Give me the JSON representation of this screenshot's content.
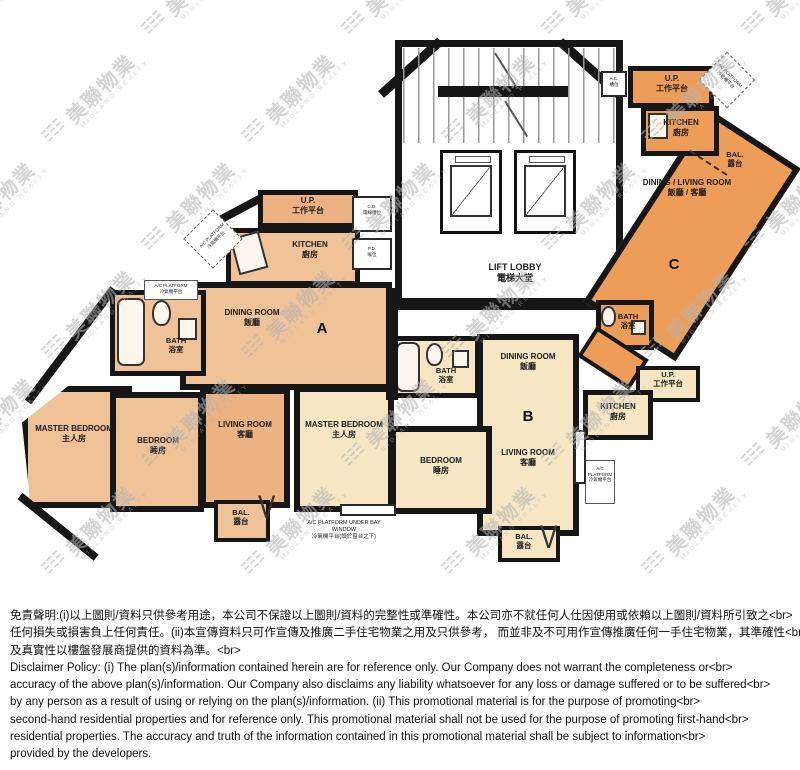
{
  "watermark": {
    "text": "美聯物業",
    "subtext": "MIDLAND REALTY"
  },
  "symbols": {
    "door_swing": "V"
  },
  "colors": {
    "wall": "#161616",
    "unit_a": "#f0c298",
    "unit_a_living": "#ecb281",
    "unit_b": "#f7e6c4",
    "unit_c": "#ee9d58",
    "core": "#ffffff"
  },
  "units": {
    "a": {
      "letter": "A"
    },
    "b": {
      "letter": "B"
    },
    "c": {
      "letter": "C"
    }
  },
  "labels": {
    "lift_lobby": {
      "en": "LIFT LOBBY",
      "zh": "電梯大堂"
    },
    "a_up": {
      "en": "U.P.",
      "zh": "工作平台"
    },
    "a_kitchen": {
      "en": "KITCHEN",
      "zh": "廚房"
    },
    "a_cd": {
      "en": "C.D.",
      "zh": "電線槽位"
    },
    "a_pd": {
      "en": "P.D.",
      "zh": "喉位"
    },
    "a_acp": {
      "en": "A/C PLATFORM",
      "zh": "冷氣機平台"
    },
    "a_bath_acp": {
      "en": "A/C PLATFORM",
      "zh": "冷氣機平台"
    },
    "a_bath": {
      "en": "BATH",
      "zh": "浴室"
    },
    "a_dining": {
      "en": "DINING ROOM",
      "zh": "飯廳"
    },
    "a_living": {
      "en": "LIVING ROOM",
      "zh": "客廳"
    },
    "a_master": {
      "en": "MASTER BEDROOM",
      "zh": "主人房"
    },
    "a_bedroom": {
      "en": "BEDROOM",
      "zh": "睡房"
    },
    "a_bal": {
      "en": "BAL.",
      "zh": "露台"
    },
    "acp_bay": {
      "en": "A/C PLATFORM UNDER BAY WINDOW",
      "zh": "冷氣機平台(設於窗台之下)"
    },
    "b_master": {
      "en": "MASTER BEDROOM",
      "zh": "主人房"
    },
    "b_bath": {
      "en": "BATH",
      "zh": "浴室"
    },
    "b_dining": {
      "en": "DINING ROOM",
      "zh": "飯廳"
    },
    "b_bedroom": {
      "en": "BEDROOM",
      "zh": "睡房"
    },
    "b_living": {
      "en": "LIVING ROOM",
      "zh": "客廳"
    },
    "b_bal": {
      "en": "BAL.",
      "zh": "露台"
    },
    "b_kitchen": {
      "en": "KITCHEN",
      "zh": "廚房"
    },
    "b_up": {
      "en": "U.P.",
      "zh": "工作平台"
    },
    "b_acp": {
      "en": "A/C PLATFORM",
      "zh": "冷氣機平台"
    },
    "c_up": {
      "en": "U.P.",
      "zh": "工作平台"
    },
    "c_ac": {
      "en": "A.C.",
      "zh": "槽位"
    },
    "c_acp": {
      "en": "AC PLATFORM",
      "zh": "冷氣機平台"
    },
    "c_kitchen": {
      "en": "KITCHEN",
      "zh": "廚房"
    },
    "c_bal": {
      "en": "BAL.",
      "zh": "露台"
    },
    "c_dl": {
      "en": "DINING / LIVING ROOM",
      "zh": "飯廳 / 客廳"
    },
    "c_bath": {
      "en": "BATH",
      "zh": "浴室"
    }
  },
  "disclaimer": {
    "zh_lines": [
      "免責聲明:(i)以上圖則/資料只供參考用途，本公司不保證以上圖則/資料的完整性或準確性。本公司亦不就任何人仕因使用或依賴以上圖則/資料所引致之<br>",
      "任何損失或損害負上任何責任。(ii)本宣傳資料只可作宣傳及推廣二手住宅物業之用及只供參考， 而並非及不可用作宣傳推廣任何一手住宅物業，其準確性<br>",
      "及真實性以樓盤發展商提供的資料為準。<br>"
    ],
    "en_lines": [
      "Disclaimer Policy: (i) The plan(s)/information contained herein are for reference only. Our Company does not warrant the completeness or<br>",
      "accuracy of the above plan(s)/information. Our Company also disclaims any liability whatsoever for any loss or damage suffered or to be suffered<br>",
      "by any person as a result of using or relying on the plan(s)/information. (ii) This promotional material is for the purpose of promoting<br>",
      "second-hand residential properties and for reference only. This promotional material shall not be used for the purpose of promoting first-hand<br>",
      "residential properties. The accuracy and truth of the information contained in this promotional material shall be subject to information<br>",
      "provided by the developers."
    ]
  }
}
